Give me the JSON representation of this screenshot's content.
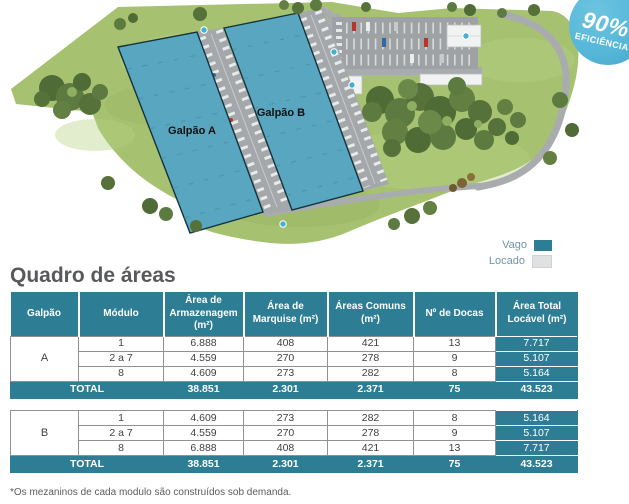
{
  "colors": {
    "teal": "#2d7e95",
    "badge_blue": "#55b6d8",
    "vacant_swatch": "#2d7e95",
    "leased_swatch": "#e0e1e2",
    "warehouse_fill": "#58a6bf"
  },
  "badge": {
    "value": "90%",
    "label": "EFICIÊNCIA"
  },
  "site_plan": {
    "labels": {
      "galpao_a": "Galpão A",
      "galpao_b": "Galpão B"
    }
  },
  "legend": {
    "items": [
      {
        "label": "Vago"
      },
      {
        "label": "Locado"
      }
    ]
  },
  "title": "Quadro de áreas",
  "table": {
    "headers": [
      "Galpão",
      "Módulo",
      "Área de Armazenagem (m²)",
      "Área de Marquise (m²)",
      "Áreas Comuns (m²)",
      "Nº de Docas",
      "Área Total Locável (m²)"
    ],
    "sections": [
      {
        "galpao": "A",
        "rows": [
          [
            "1",
            "6.888",
            "408",
            "421",
            "13",
            "7.717"
          ],
          [
            "2 a 7",
            "4.559",
            "270",
            "278",
            "9",
            "5.107"
          ],
          [
            "8",
            "4.609",
            "273",
            "282",
            "8",
            "5.164"
          ]
        ],
        "total_label": "TOTAL",
        "totals": [
          "38.851",
          "2.301",
          "2.371",
          "75",
          "43.523"
        ]
      },
      {
        "galpao": "B",
        "rows": [
          [
            "1",
            "4.609",
            "273",
            "282",
            "8",
            "5.164"
          ],
          [
            "2 a 7",
            "4.559",
            "270",
            "278",
            "9",
            "5.107"
          ],
          [
            "8",
            "6.888",
            "408",
            "421",
            "13",
            "7.717"
          ]
        ],
        "total_label": "TOTAL",
        "totals": [
          "38.851",
          "2.301",
          "2.371",
          "75",
          "43.523"
        ]
      }
    ]
  },
  "footnote": "*Os mezaninos de cada modulo são construídos sob demanda."
}
